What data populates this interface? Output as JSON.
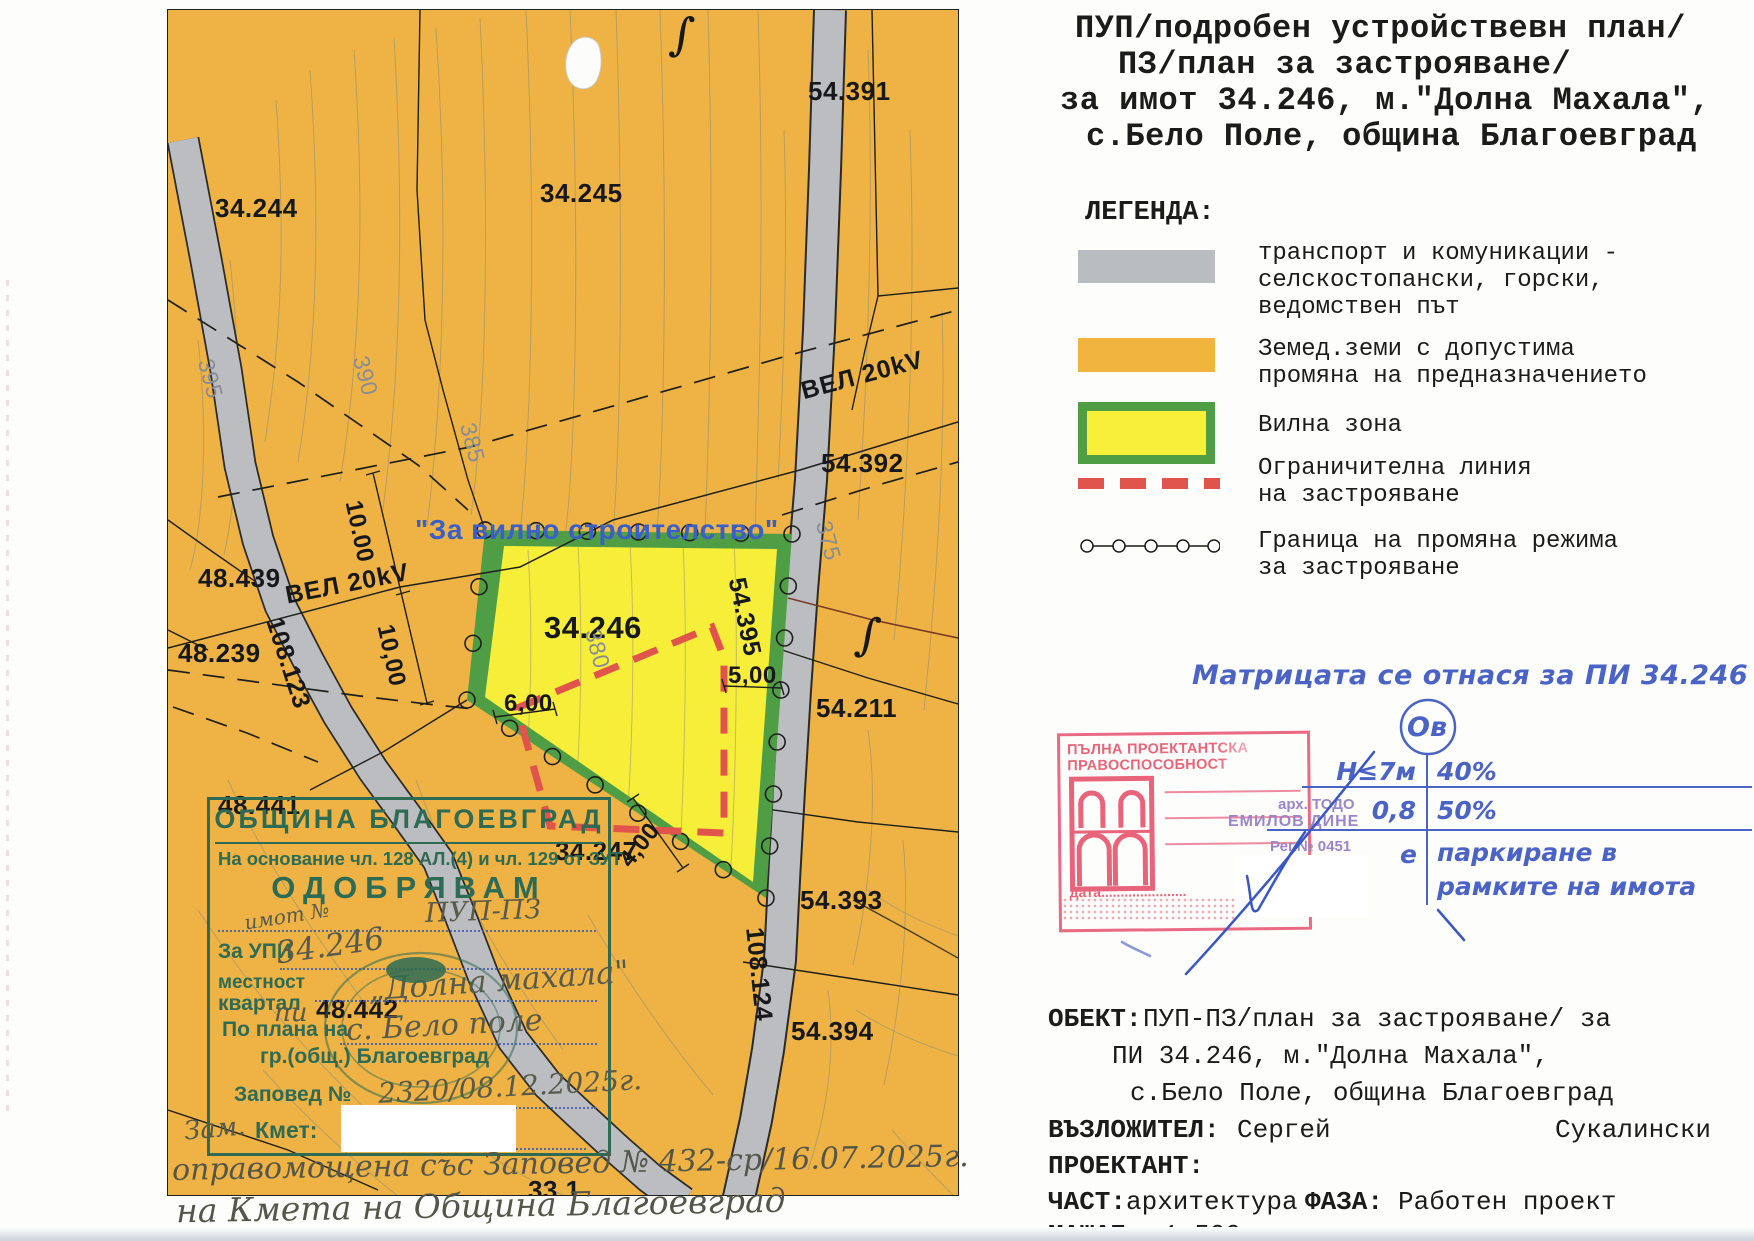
{
  "title": {
    "lines": [
      "ПУП/подробен устройствевн план/",
      "ПЗ/план за застрояване/",
      "за имот 34.246, м.\"Долна Махала\",",
      "с.Бело Поле, община Благоевград"
    ]
  },
  "legend": {
    "heading": "ЛЕГЕНДА:",
    "items": [
      {
        "name": "road-swatch",
        "color": "#b9bdc0",
        "lines": [
          "транспорт и комуникации -",
          "селскостопански, горски,",
          "ведомствен път"
        ]
      },
      {
        "name": "agri-land-swatch",
        "color": "#f0b43f",
        "lines": [
          "Земед.земи с допустима",
          "промяна на предназначението"
        ]
      },
      {
        "name": "villa-zone-swatch",
        "color": "#f8ef39",
        "border": "#4f9d45",
        "lines": [
          "Вилна зона"
        ]
      },
      {
        "name": "building-limit-line-swatch",
        "color": "#e0544b",
        "lines": [
          "Ограничителна линия",
          "на застрояване"
        ]
      },
      {
        "name": "regime-change-boundary-swatch",
        "color": "#1a1a1a",
        "lines": [
          "Граница на промяна режима",
          "за застрояване"
        ]
      }
    ]
  },
  "matrix": {
    "note": "Матрицата се отнася за ПИ 34.246",
    "symbol": "Ов",
    "row1_left": "H≤7м",
    "row1_right": "40%",
    "row2_left": "0,8",
    "row2_right": "50%",
    "row3_left": "е",
    "row3_right_line1": "паркиране в",
    "row3_right_line2": "рамките на имота"
  },
  "cert_stamp": {
    "header": "ПЪЛНА ПРОЕКТАНТСКА ПРАВОСПОСОБНОСТ",
    "arch_line1": "арх. ТОДО",
    "arch_line2": "ЕМИЛОВ ДИНЕ",
    "reg": "Рег.№ 0451",
    "date_label": "дата......................"
  },
  "approval_stamp": {
    "title": "ОБЩИНА БЛАГОЕВГРАД",
    "legal": "На основание чл. 128 АЛ.(4) и чл. 129 от ЗУТ",
    "approve": "ОДОБРЯВАМ",
    "hw_plan": "ПУП-ПЗ",
    "for_label": "За УПИ",
    "hw_imot_small": "имот №",
    "hw_imot": "34.246",
    "mestnost": "местност",
    "kvartal": "квартал",
    "hw_mestnost": "„Долна махала\"",
    "hw_pi": "пи",
    "po_plana": "По плана на",
    "hw_selo": "с. Бело поле",
    "grad": "гр.(общ.) Благоевград",
    "zapoved": "Заповед №",
    "hw_zapoved": "2320/08.12.2025г.",
    "hw_zam": "Зам.",
    "kmet": "Кмет:"
  },
  "handwriting": {
    "line1": "оправомощена със Заповед № 432-ср/16.07.2025г.",
    "line2": "на Кмета на Община Благоевград"
  },
  "project": {
    "obekt_label": "ОБЕКТ:",
    "obekt_line1": "ПУП-ПЗ/план за застрояване/ за",
    "obekt_line2": "ПИ 34.246, м.\"Долна Махала\",",
    "obekt_line3": "с.Бело Поле, община Благоевград",
    "client_label": "ВЪЗЛОЖИТЕЛ:",
    "client_first": "Сергей",
    "client_last": "Сукалински",
    "designer_label": "ПРОЕКТАНТ:",
    "part_label": "ЧАСТ:",
    "part_value": "архитектура",
    "phase_label": "ФАЗА:",
    "phase_value": "Работен проект",
    "scale_label": "МАЩАБ",
    "scale_value": "1:500"
  },
  "map": {
    "colors": {
      "land": "#eeb344",
      "road": "#bcbdc1",
      "zone_fill": "#f7ee3a",
      "zone_border": "#4f9d45",
      "limit_line": "#e0544b"
    },
    "labels": [
      {
        "text": "34.244",
        "x": 47,
        "y": 183,
        "cls": ""
      },
      {
        "text": "34.245",
        "x": 372,
        "y": 168,
        "cls": ""
      },
      {
        "text": "54.391",
        "x": 640,
        "y": 66,
        "cls": ""
      },
      {
        "text": "48.439",
        "x": 30,
        "y": 553,
        "cls": ""
      },
      {
        "text": "48.239",
        "x": 10,
        "y": 628,
        "cls": ""
      },
      {
        "text": "48.441",
        "x": 50,
        "y": 780,
        "cls": ""
      },
      {
        "text": "48.442",
        "x": 148,
        "y": 984,
        "cls": ""
      },
      {
        "text": "34.247",
        "x": 387,
        "y": 826,
        "cls": ""
      },
      {
        "text": "54.392",
        "x": 653,
        "y": 438,
        "cls": ""
      },
      {
        "text": "54.211",
        "x": 648,
        "y": 683,
        "cls": ""
      },
      {
        "text": "54.393",
        "x": 632,
        "y": 875,
        "cls": ""
      },
      {
        "text": "54.394",
        "x": 623,
        "y": 1006,
        "cls": ""
      },
      {
        "text": "33.1",
        "x": 360,
        "y": 1165,
        "cls": ""
      },
      {
        "text": "34.246",
        "x": 376,
        "y": 600,
        "cls": "big"
      },
      {
        "text": "108.123",
        "x": 119,
        "y": 604,
        "rot": 72,
        "cls": "roadlbl"
      },
      {
        "text": "108.124",
        "x": 600,
        "y": 916,
        "rot": 84,
        "cls": "roadlbl"
      },
      {
        "text": "54.395",
        "x": 582,
        "y": 565,
        "rot": 78,
        "cls": "roadlbl"
      },
      {
        "text": "ВЕЛ 20kV",
        "x": 115,
        "y": 572,
        "rot": -11,
        "cls": "power"
      },
      {
        "text": "ВЕЛ 20kV",
        "x": 630,
        "y": 368,
        "rot": -15,
        "cls": "power"
      },
      {
        "text": "395",
        "x": 50,
        "y": 346,
        "rot": 75,
        "cls": "contour"
      },
      {
        "text": "390",
        "x": 205,
        "y": 343,
        "rot": 75,
        "cls": "contour"
      },
      {
        "text": "385",
        "x": 312,
        "y": 410,
        "rot": 75,
        "cls": "contour"
      },
      {
        "text": "380",
        "x": 437,
        "y": 616,
        "rot": 75,
        "cls": "contour"
      },
      {
        "text": "375",
        "x": 668,
        "y": 508,
        "rot": 75,
        "cls": "contour"
      },
      {
        "text": "10.00",
        "x": 198,
        "y": 488,
        "rot": 78,
        "cls": "dim"
      },
      {
        "text": "10,00",
        "x": 230,
        "y": 612,
        "rot": 78,
        "cls": "dim"
      },
      {
        "text": "6,00",
        "x": 336,
        "y": 680,
        "cls": "dim"
      },
      {
        "text": "5,00",
        "x": 560,
        "y": 652,
        "cls": "dim"
      },
      {
        "text": "4,00",
        "x": 446,
        "y": 846,
        "rot": -52,
        "cls": "dim"
      },
      {
        "text": "∫",
        "x": 505,
        "y": -4,
        "rot": 6,
        "cls": "sym"
      },
      {
        "text": "∫",
        "x": 692,
        "y": 596,
        "rot": 8,
        "cls": "sym"
      },
      {
        "text": "\"За вилно строителство\"",
        "x": 247,
        "y": 504,
        "cls": "blue"
      }
    ]
  }
}
